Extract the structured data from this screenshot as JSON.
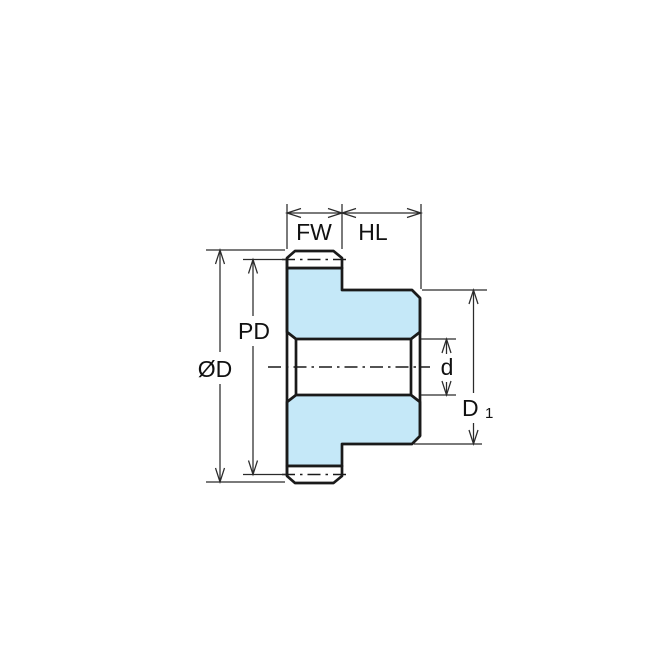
{
  "diagram": {
    "type": "technical-drawing",
    "subject": "gear-sprocket-cross-section",
    "labels": {
      "face_width": "FW",
      "hub_length": "HL",
      "pitch_diameter": "PD",
      "outside_diameter": "ØD",
      "bore_diameter": "d",
      "hub_diameter_main": "D",
      "hub_diameter_sub": "1"
    },
    "colors": {
      "part_fill": "#C5E8F8",
      "part_outline": "#1A1A1A",
      "dimension_lines": "#2B2B2B",
      "text": "#111111",
      "background": "#FFFFFF"
    }
  }
}
